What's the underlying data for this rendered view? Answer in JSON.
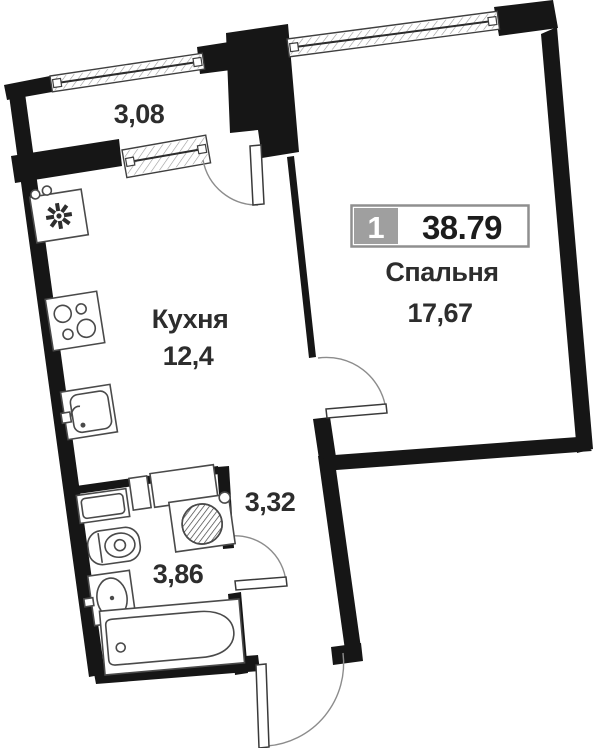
{
  "plan": {
    "badge": {
      "rooms_count": "1",
      "total_area": "38.79"
    },
    "rooms": {
      "balcony": {
        "area": "3,08"
      },
      "kitchen": {
        "name": "Кухня",
        "area": "12,4"
      },
      "bedroom": {
        "name": "Спальня",
        "area": "17,67"
      },
      "hallway": {
        "area": "3,32"
      },
      "bathroom": {
        "area": "3,86"
      }
    },
    "icons": {
      "kitchen_sink": "star-drain-icon",
      "stove": "four-burner-stove-icon",
      "washing_machine": "washer-drum-icon",
      "toilet": "toilet-icon",
      "washbasin": "washbasin-icon",
      "bathtub": "bathtub-icon",
      "window": "hatched-window-icon",
      "door": "quarter-arc-door-icon"
    },
    "colors": {
      "wall": "#161616",
      "fixture_line": "#4a4a4a",
      "arc_line": "#8c8c8c",
      "leaf_line": "#3a3a3a",
      "badge_gray": "#9f9f9f",
      "badge_border": "#8f8f8f",
      "badge_area_text": "#1c1c1c",
      "text": "#2d2d2d",
      "background": "#ffffff"
    }
  }
}
